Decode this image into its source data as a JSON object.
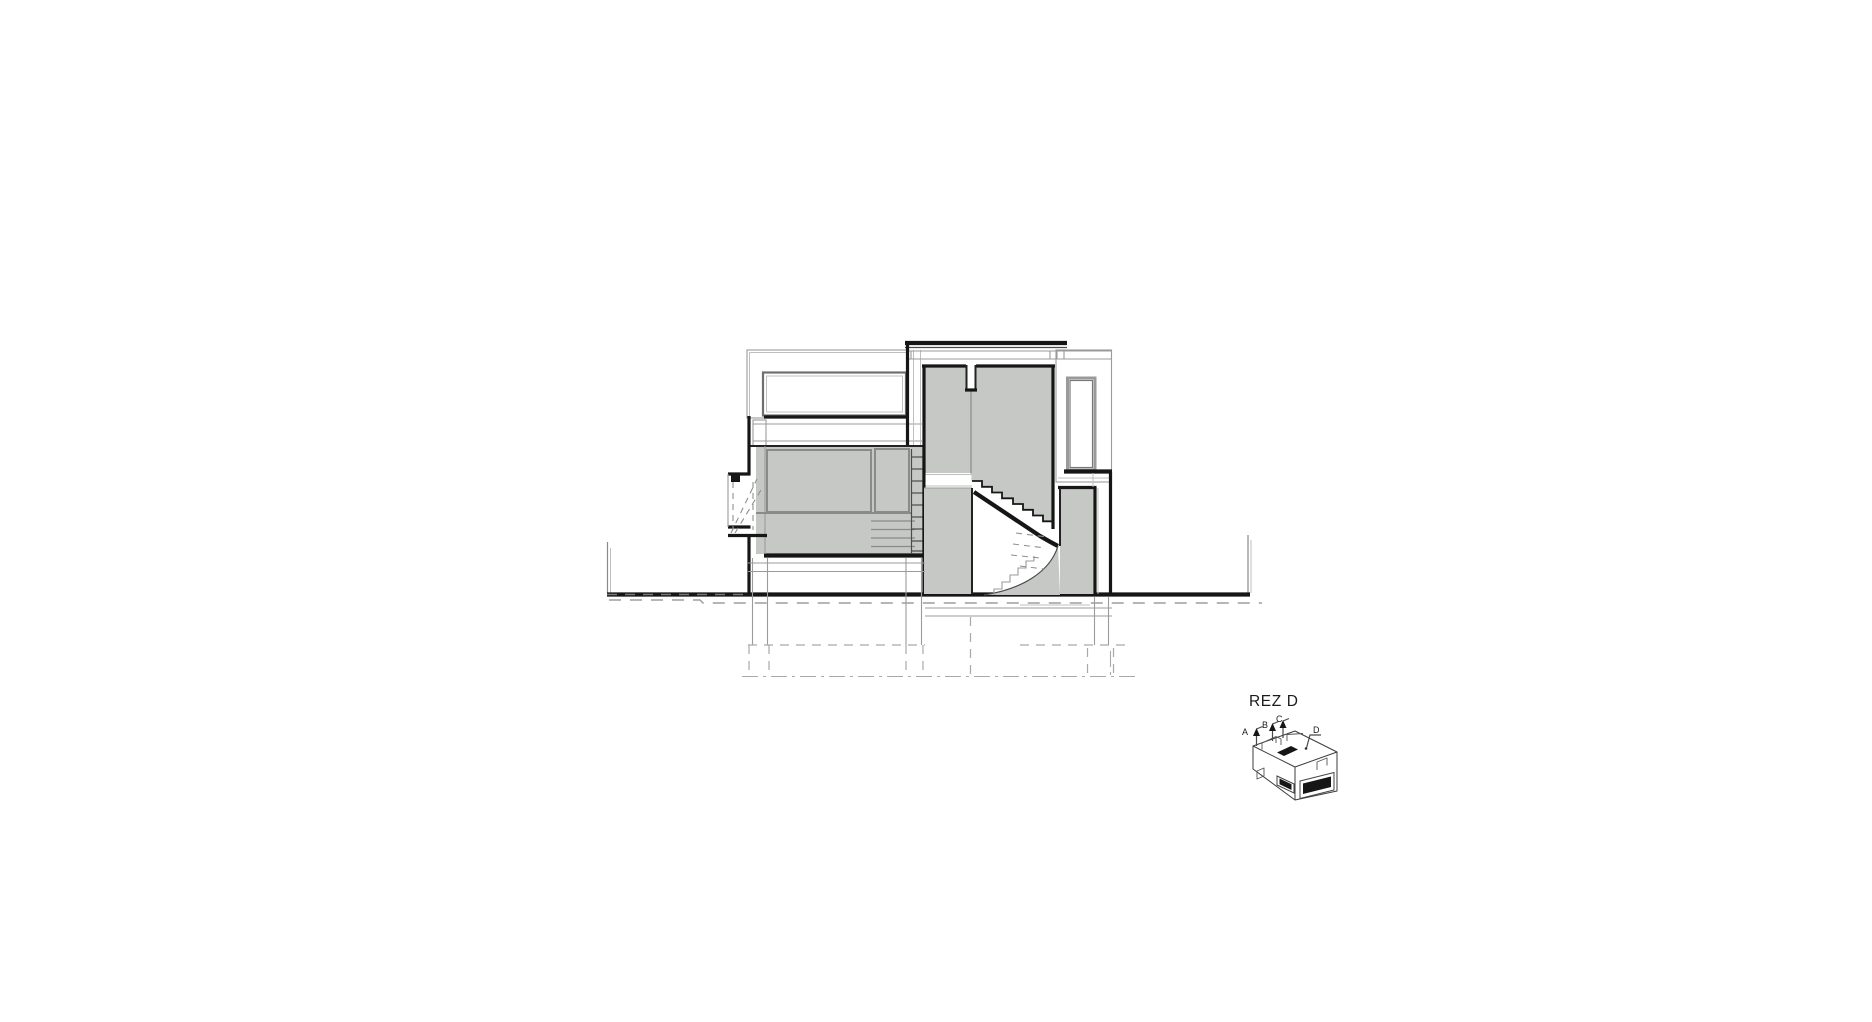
{
  "drawing": {
    "title": "REZ D",
    "key_plan": {
      "markers": [
        {
          "label": "A"
        },
        {
          "label": "B"
        },
        {
          "label": "C"
        },
        {
          "label": "D"
        }
      ]
    },
    "colors": {
      "background": "#ffffff",
      "wall_fill": "#c6c8c6",
      "ink": "#161616",
      "light_line": "#9b9b9b",
      "dashed_line": "#a9a9a9"
    }
  }
}
